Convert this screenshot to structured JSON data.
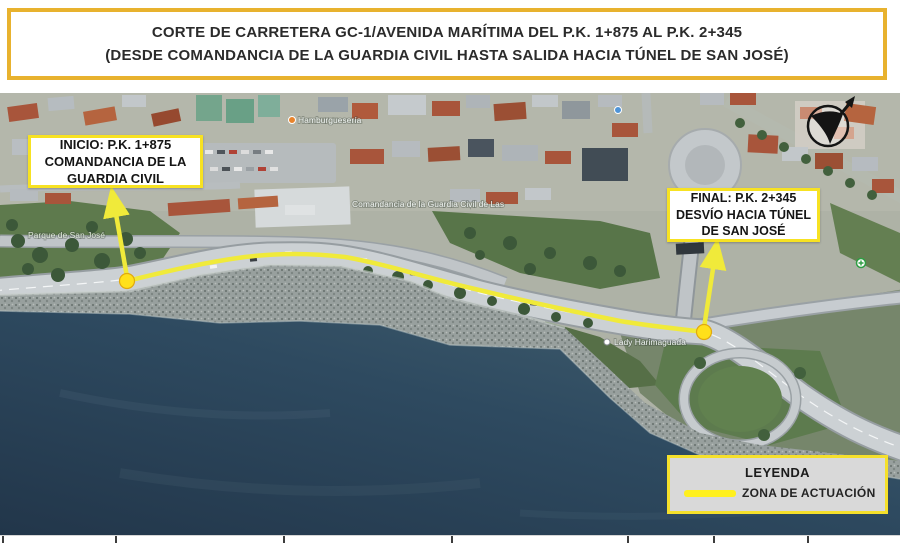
{
  "banner": {
    "line1": "CORTE DE CARRETERA GC-1/AVENIDA MARÍTIMA DEL P.K. 1+875 AL P.K. 2+345",
    "line2": "(DESDE COMANDANCIA DE LA GUARDIA CIVIL HASTA SALIDA HACIA TÚNEL DE SAN JOSÉ)"
  },
  "callouts": {
    "inicio": {
      "line1": "INICIO: P.K. 1+875",
      "line2": "COMANDANCIA DE LA",
      "line3": "GUARDIA CIVIL"
    },
    "final": {
      "line1": "FINAL: P.K. 2+345",
      "line2": "DESVÍO HACIA TÚNEL",
      "line3": "DE SAN JOSÉ"
    }
  },
  "legend": {
    "title": "LEYENDA",
    "item_label": "ZONA DE ACTUACIÓN"
  },
  "map_labels": {
    "park": "Parque de San José",
    "comandancia": "Comandancia de la Guardia Civil de Las",
    "monument": "Lady Harimaguada",
    "restaurant": "Hamburguesería"
  },
  "colors": {
    "action_zone_yellow": "#F0EA3A",
    "callout_border": "#F7E222",
    "banner_border": "#E8B22E",
    "legend_background": "#D9D9D9",
    "ocean_dark": "#2C4257"
  }
}
